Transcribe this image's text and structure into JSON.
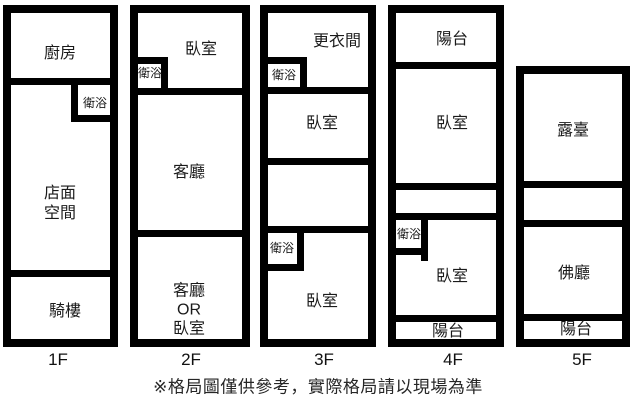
{
  "page": {
    "background": "#ffffff",
    "wall_color": "#000000",
    "text_color": "#1a1a1a"
  },
  "floors": {
    "f1": {
      "label": "1F",
      "kitchen": "廚房",
      "bath": "衛浴",
      "storefront_line1": "店面",
      "storefront_line2": "空間",
      "arcade": "騎樓"
    },
    "f2": {
      "label": "2F",
      "bedroom": "臥室",
      "bath": "衛浴",
      "living_room": "客廳",
      "flex_line1": "客廳",
      "flex_line2": "OR",
      "flex_line3": "臥室"
    },
    "f3": {
      "label": "3F",
      "dressing_room": "更衣間",
      "bath_upper": "衛浴",
      "bedroom_upper": "臥室",
      "bath_lower": "衛浴",
      "bedroom_lower": "臥室"
    },
    "f4": {
      "label": "4F",
      "balcony_upper": "陽台",
      "bedroom_upper": "臥室",
      "bath": "衛浴",
      "bedroom_lower": "臥室",
      "balcony_lower": "陽台"
    },
    "f5": {
      "label": "5F",
      "terrace": "露臺",
      "buddha_hall": "佛廳",
      "balcony": "陽台"
    }
  },
  "footer": {
    "disclaimer": "※格局圖僅供參考，實際格局請以現場為準"
  }
}
